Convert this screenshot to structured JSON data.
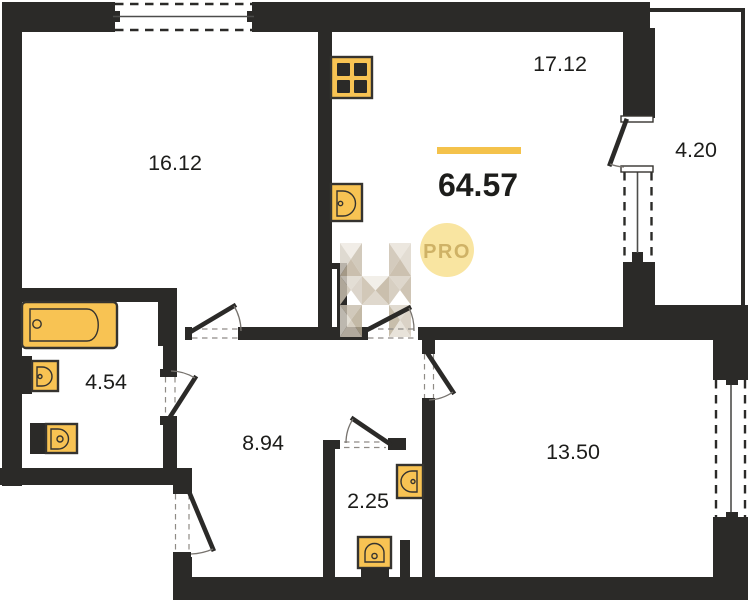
{
  "type": "floor-plan",
  "total": {
    "area": "64.57"
  },
  "rooms": {
    "bedroom": {
      "area": "16.12"
    },
    "living_room": {
      "area": "17.12"
    },
    "balcony": {
      "area": "4.20"
    },
    "bathroom": {
      "area": "4.54"
    },
    "hallway": {
      "area": "8.94"
    },
    "wc": {
      "area": "2.25"
    },
    "bedroom2": {
      "area": "13.50"
    }
  },
  "badge": {
    "label": "PRO"
  },
  "watermark": {
    "letter": "H"
  },
  "fixtures": [
    "stove-icon",
    "kitchen-sink-icon",
    "bathtub-icon",
    "bathroom-sink-icon",
    "toilet-icon",
    "wc-sink-icon",
    "wc-toilet-icon"
  ],
  "colors": {
    "wall": "#2b2a28",
    "fixture": "#f8c353",
    "accent": "#f4c24b",
    "pro_bg": "#f9e5a1",
    "pro_text": "#cfb266",
    "label": "#1d1d1b"
  }
}
